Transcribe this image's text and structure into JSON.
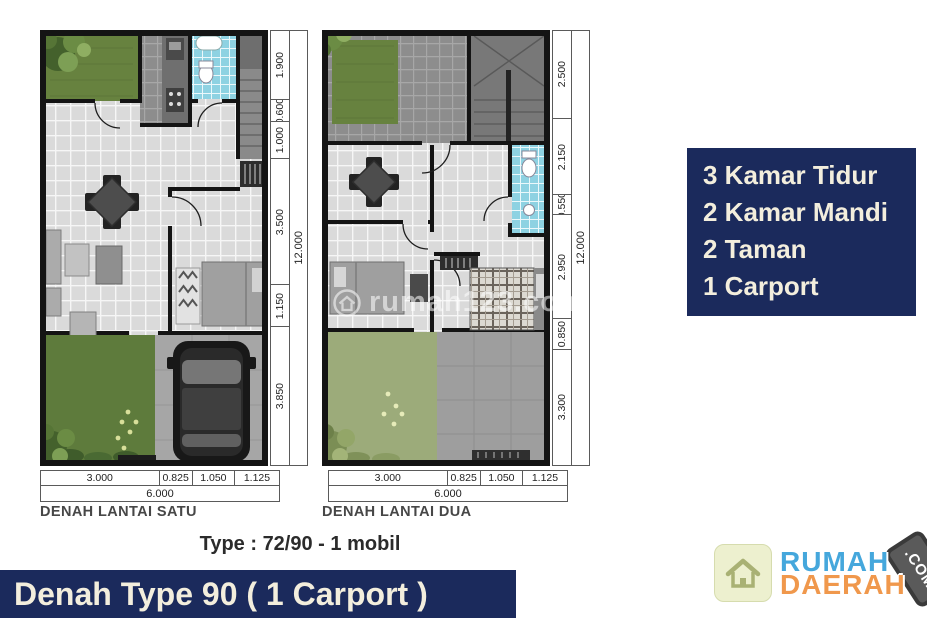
{
  "page": {
    "background": "#ffffff",
    "accent_navy": "#1b2a5c",
    "cream_text": "#f3eedd"
  },
  "plans": [
    {
      "label": "DENAH LANTAI SATU",
      "side_dims": [
        "1.900",
        "0.600",
        "1.000",
        "3.500",
        "1.150",
        "3.850"
      ],
      "side_total": "12.000",
      "bottom_dims": [
        "3.000",
        "0.825",
        "1.050",
        "1.125"
      ],
      "bottom_total": "6.000"
    },
    {
      "label": "DENAH LANTAI DUA",
      "side_dims": [
        "2.500",
        "2.150",
        "0.550",
        "2.950",
        "0.850",
        "3.300"
      ],
      "side_total": "12.000",
      "bottom_dims": [
        "3.000",
        "0.825",
        "1.050",
        "1.125"
      ],
      "bottom_total": "6.000"
    }
  ],
  "type_caption": "Type : 72/90 - 1 mobil",
  "features": {
    "bg": "#1b2a5c",
    "text_color": "#f3eedd",
    "items": [
      "3 Kamar Tidur",
      "2 Kamar Mandi",
      "2 Taman",
      "1 Carport"
    ]
  },
  "title_bar": {
    "text": "Denah Type 90 ( 1 Carport )",
    "bg": "#1b2a5c",
    "text_color": "#f3eedd"
  },
  "watermark": {
    "text": "rumah123.com"
  },
  "logo": {
    "word_top": "RUMAH",
    "word_bottom": "DAERAH",
    "tag": ".COM",
    "word_top_color": "#45a7dc",
    "word_bottom_color": "#f0984c"
  }
}
